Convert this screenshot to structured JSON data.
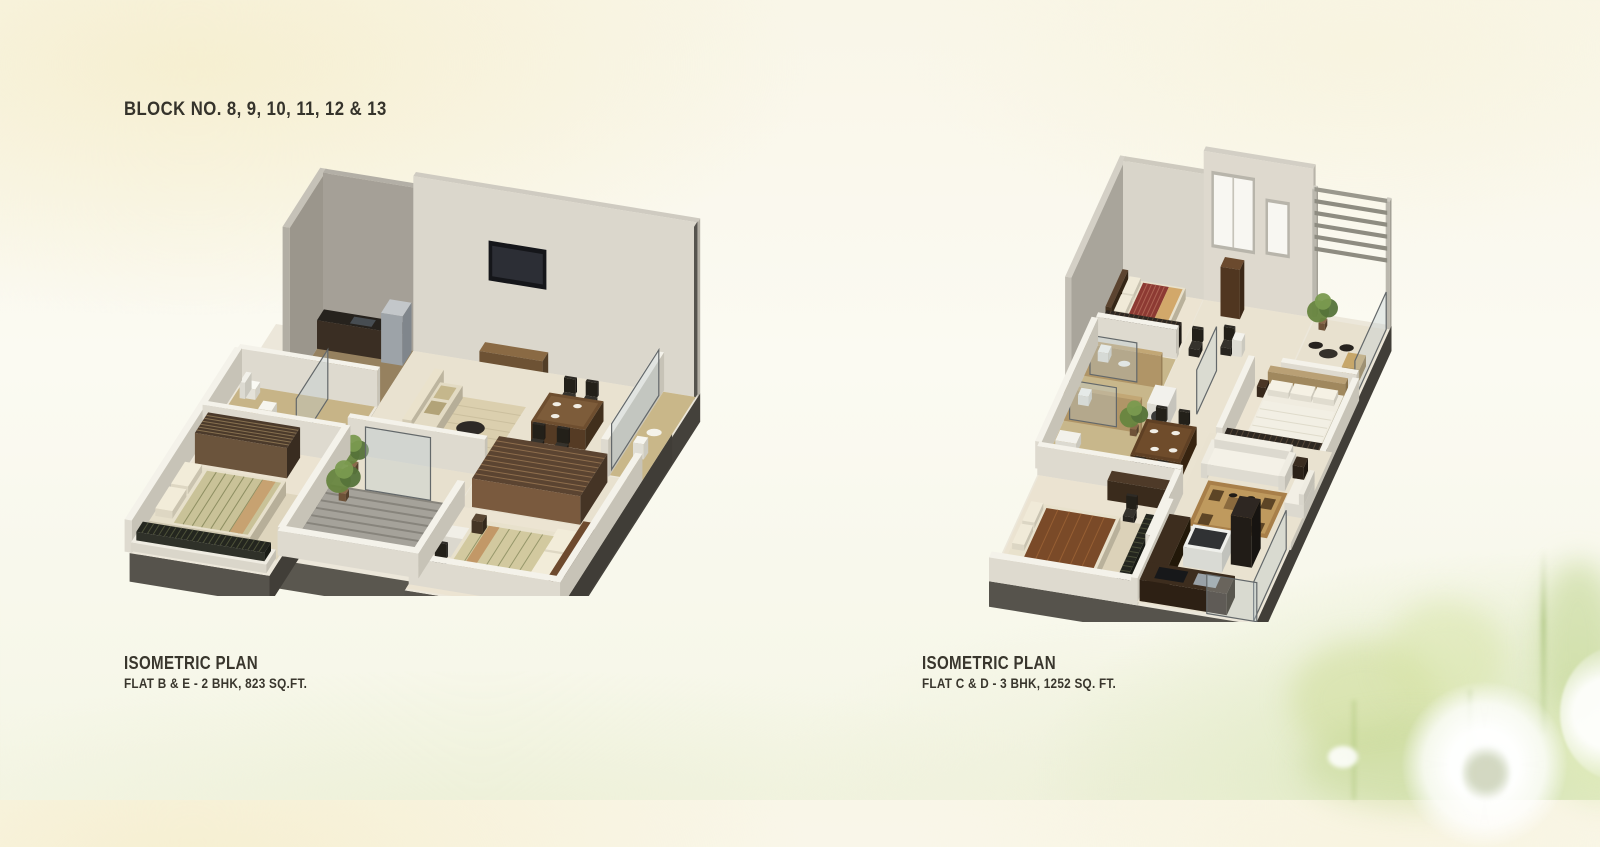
{
  "header": {
    "text": "BLOCK NO. 8, 9, 10, 11, 12 & 13"
  },
  "plans": [
    {
      "title": "ISOMETRIC PLAN",
      "subtitle": "FLAT B & E - 2 BHK, 823 SQ.FT.",
      "illustration": "2bhk-isometric-floorplan"
    },
    {
      "title": "ISOMETRIC PLAN",
      "subtitle": "FLAT C & D - 3 BHK, 1252 SQ. FT.",
      "illustration": "3bhk-isometric-floorplan"
    }
  ],
  "palette": {
    "page_cream": "#f6efd1",
    "page_green": "#d9e6b8",
    "text": "#39362d",
    "plinth_dark": "#56534c",
    "wall_light": "#dbd7cc",
    "floor_cream": "#ece4d2"
  }
}
